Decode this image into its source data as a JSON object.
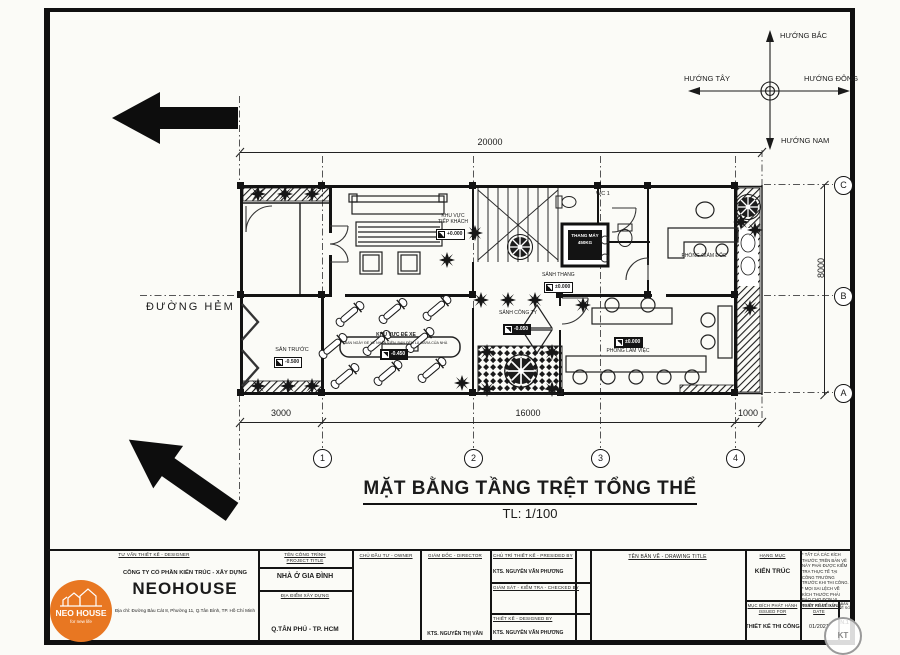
{
  "compass": {
    "north": "HƯỚNG BẮC",
    "west": "HƯỚNG TÂY",
    "east": "HƯỚNG ĐÔNG",
    "south": "HƯỚNG NAM"
  },
  "site": {
    "street": "ĐƯỜNG HẺM"
  },
  "rooms": {
    "reception": {
      "line1": "KHU VỰC",
      "line2": "TIẾP KHÁCH",
      "level": "+0.000"
    },
    "stair_lobby": {
      "label": "SẢNH THANG",
      "level": "±0.000"
    },
    "elevator": {
      "line1": "THANG MÁY",
      "line2": "450KG"
    },
    "wc": {
      "label": "WC 1"
    },
    "director": {
      "label": "PHÒNG GIÁM ĐỐC"
    },
    "front_yard": {
      "label": "SÂN TRƯỚC",
      "level": "-0.500"
    },
    "parking": {
      "label": "KHU VỰC ĐỂ XE",
      "note": "BAN NGÀY ĐỂ XE NHÂN VIÊN, BAN ĐÊM LÀ GARA CỦA NHÀ",
      "level": "-0.450"
    },
    "company_lobby": {
      "label": "SẢNH CÔNG TY",
      "level": "-0.050"
    },
    "office": {
      "label": "PHÒNG LÀM VIỆC",
      "level": "±0.000"
    }
  },
  "dimensions": {
    "top": "20000",
    "right": "8000",
    "bottom": [
      "3000",
      "16000",
      "1000"
    ]
  },
  "grid": {
    "columns": [
      "1",
      "2",
      "3",
      "4"
    ],
    "rows": [
      "C",
      "B",
      "A"
    ]
  },
  "title": {
    "main": "MẶT BẰNG TẦNG TRỆT TỔNG THỂ",
    "scale": "TL: 1/100"
  },
  "titleblock": {
    "designer_header": "TƯ VẤN THIẾT KẾ - DESIGNER",
    "logo": {
      "name": "NEO HOUSE",
      "tagline": "for new life"
    },
    "company_type": "CÔNG TY CỔ PHẦN KIẾN TRÚC - XÂY DỰNG",
    "company_name": "NEOHOUSE",
    "company_address": "Địa chỉ: Đường Bàu Cát 8, Phường 11, Q.Tân Bình, TP. Hồ Chí Minh",
    "project_header_vi": "TÊN CÔNG TRÌNH",
    "project_header_en": "PROJECT TITLE",
    "project_name": "NHÀ Ở GIA ĐÌNH",
    "location_header": "ĐỊA ĐIỂM XÂY DỰNG",
    "location": "Q.TÂN PHÚ - TP. HCM",
    "owner_header": "CHỦ ĐẦU TƯ - OWNER",
    "director_header": "GIÁM ĐỐC - DIRECTOR",
    "director_name": "KTS. NGUYỄN THỊ VÂN",
    "presided_header": "CHỦ TRÌ THIẾT KẾ - PRESIDED BY",
    "presided_name": "KTS. NGUYỄN VĂN PHƯƠNG",
    "checked_header": "GIÁM SÁT - KIỂM TRA - CHECKED BY",
    "designed_header": "THIẾT KẾ - DESIGNED BY",
    "designed_name": "KTS. NGUYỄN VĂN PHƯƠNG",
    "drawing_title_header": "TÊN BẢN VẼ - DRAWING TITLE",
    "category_header": "HẠNG MỤC",
    "category": "KIẾN TRÚC",
    "issued_header_vi": "MỤC ĐÍCH PHÁT HÀNH",
    "issued_header_en": "ISSUED FOR",
    "issued": "THIẾT KẾ THI CÔNG",
    "date_header_vi": "NGÀY PHÁT HÀNH",
    "date_header_en": "DATE",
    "date": "01/2021",
    "sheet_header": "BẢN VẼ SỐ",
    "sheet_no": "N.1",
    "notes": "* TẤT CẢ CÁC KÍCH THƯỚC TRÊN BẢN VẼ NÀY PHẢI ĐƯỢC KIỂM TRA THỰC TẾ TẠI CÔNG TRƯỜNG TRƯỚC KHI THI CÔNG. * MỌI SAI LỆCH VỀ KÍCH THƯỚC PHẢI BÁO CHO ĐƠN VỊ THIẾT KẾ ĐỂ XỬ LÝ.",
    "stamp": "KT"
  }
}
